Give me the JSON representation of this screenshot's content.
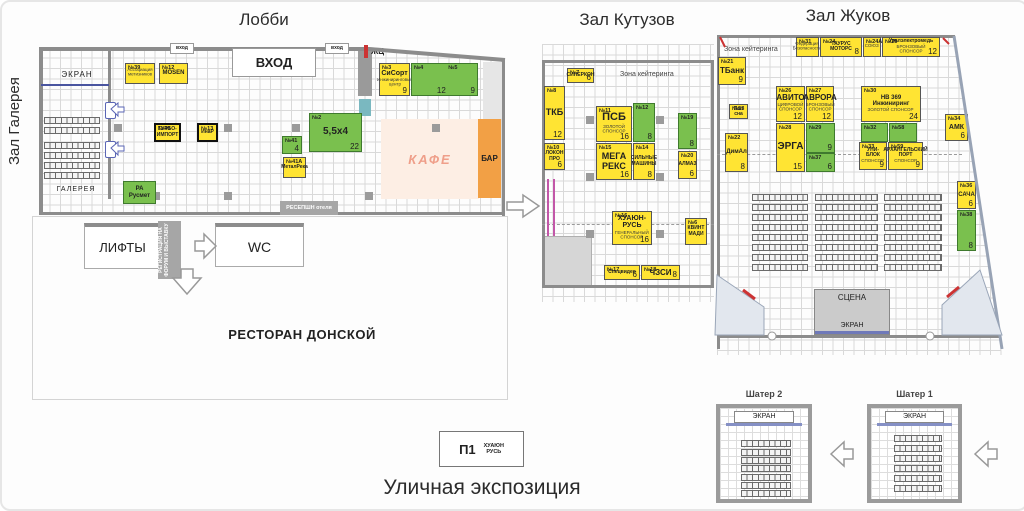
{
  "colors": {
    "yellow": "#ffe433",
    "green": "#7ac04e",
    "orange": "#f2a045",
    "cafe_bg": "#fdeee4",
    "cafe_text": "#ef9f8a",
    "wall": "#8c8c8c",
    "screen_bar": "#8590c5",
    "stage_bg": "#cbcbcb",
    "gray_box": "#a6a6a6",
    "red": "#cc3333"
  },
  "titles": {
    "lobby": "Лобби",
    "kutuzov": "Зал Кутузов",
    "zhukov": "Зал Жуков",
    "gallery_vertical": "Зал Галерея",
    "street": "Уличная экспозиция"
  },
  "lobby": {
    "entrance_big": "ВХОД",
    "entrance_small": "вход",
    "zh": "ЖЦ",
    "screen": "ЭКРАН",
    "gallery": "ГАЛЕРЕЯ",
    "cafe": "КАФЕ",
    "bar": "БАР",
    "reception": "РЕСЕПШН отеля",
    "stands": [
      {
        "num": "№39",
        "sub": "Ассоциация метизников",
        "x": 123,
        "y": 61,
        "w": 30,
        "h": 21,
        "type": "yellow"
      },
      {
        "num": "№12",
        "name": "MOSEN",
        "fs": 6,
        "x": 157,
        "y": 61,
        "w": 29,
        "h": 21,
        "type": "yellow"
      },
      {
        "num": "№40",
        "name": "ТУРБО-ИМПОРТ",
        "fs": 5,
        "x": 152,
        "y": 121,
        "w": 27,
        "h": 19,
        "type": "yellow",
        "bold": true
      },
      {
        "num": "№13",
        "name": "ИнаР",
        "fs": 5,
        "x": 195,
        "y": 121,
        "w": 21,
        "h": 19,
        "type": "yellow",
        "bold": true
      },
      {
        "num": "№41",
        "size": "4",
        "x": 280,
        "y": 134,
        "w": 20,
        "h": 18,
        "type": "green"
      },
      {
        "num": "№41А",
        "name": "МеталРека",
        "fs": 5,
        "x": 281,
        "y": 155,
        "w": 23,
        "h": 21,
        "type": "yellow"
      },
      {
        "num": "№2",
        "name": "5,5x4",
        "fs": 10,
        "size": "22",
        "x": 307,
        "y": 111,
        "w": 53,
        "h": 39,
        "type": "green"
      },
      {
        "num": "№3",
        "name": "СиСорт",
        "fs": 7,
        "sub": "Инжиниринговый центр",
        "size": "9",
        "x": 377,
        "y": 61,
        "w": 31,
        "h": 33,
        "type": "yellow"
      },
      {
        "num": "№4",
        "num2": "№5",
        "size": "12",
        "size2": "9",
        "x": 409,
        "y": 61,
        "w": 67,
        "h": 33,
        "type": "green"
      },
      {
        "name": "РА Русмет",
        "fs": 6,
        "x": 121,
        "y": 179,
        "w": 33,
        "h": 23,
        "type": "green"
      }
    ]
  },
  "services": {
    "lifts": "ЛИФТЫ",
    "wc": "WC",
    "registration": "РЕГИСТРАЦИЯ НА ФОРУМ И ВЫСТАВКУ",
    "restaurant": "РЕСТОРАН ДОНСКОЙ"
  },
  "kutuzov": {
    "catering": "Зона кейтеринга",
    "stands": [
      {
        "num": "№7",
        "name": "СИНЕРКОН",
        "fs": 5,
        "size": "6",
        "x": 565,
        "y": 66,
        "w": 27,
        "h": 15,
        "type": "yellow"
      },
      {
        "num": "№8",
        "name": "ТКБ",
        "fs": 9,
        "size": "12",
        "x": 542,
        "y": 84,
        "w": 21,
        "h": 54,
        "type": "yellow"
      },
      {
        "num": "№11",
        "name": "ПСБ",
        "fs": 11,
        "sub": "ЗОЛОТОЙ СПОНСОР",
        "size": "16",
        "x": 594,
        "y": 104,
        "w": 36,
        "h": 36,
        "type": "yellow"
      },
      {
        "num": "№12",
        "size": "8",
        "x": 631,
        "y": 101,
        "w": 22,
        "h": 39,
        "type": "green"
      },
      {
        "num": "№19",
        "size": "8",
        "x": 676,
        "y": 111,
        "w": 19,
        "h": 36,
        "type": "green"
      },
      {
        "num": "№10",
        "name": "ЛОКОН ПРО",
        "fs": 5,
        "size": "6",
        "x": 542,
        "y": 141,
        "w": 21,
        "h": 27,
        "type": "yellow"
      },
      {
        "num": "№15",
        "name": "МЕГА РЕКС",
        "fs": 9,
        "size": "16",
        "x": 594,
        "y": 141,
        "w": 36,
        "h": 37,
        "type": "yellow"
      },
      {
        "num": "№14",
        "name": "СИЛЬНЫЕ МАШИНЫ",
        "fs": 5,
        "size": "8",
        "x": 631,
        "y": 141,
        "w": 22,
        "h": 37,
        "type": "yellow"
      },
      {
        "num": "№20",
        "name": "АЛМАЗ",
        "fs": 5,
        "size": "6",
        "x": 676,
        "y": 149,
        "w": 19,
        "h": 28,
        "type": "yellow"
      },
      {
        "num": "№16",
        "name": "ХУАЮН-РУСЬ",
        "fs": 7,
        "sub": "ГЕНЕРАЛЬНЫЙ СПОНСОР",
        "size": "16",
        "x": 610,
        "y": 209,
        "w": 40,
        "h": 34,
        "type": "yellow"
      },
      {
        "num": "№6",
        "name": "КВИНТ МАДИ",
        "fs": 5,
        "x": 683,
        "y": 216,
        "w": 22,
        "h": 27,
        "type": "yellow"
      },
      {
        "num": "№17",
        "name": "Спецвидео",
        "fs": 5,
        "size": "6",
        "x": 602,
        "y": 263,
        "w": 36,
        "h": 15,
        "type": "yellow"
      },
      {
        "num": "№18",
        "name": "ЧЗСИ",
        "fs": 8,
        "size": "8",
        "x": 639,
        "y": 263,
        "w": 39,
        "h": 15,
        "type": "yellow"
      }
    ]
  },
  "zhukov": {
    "catering": "Зона кейтеринга",
    "stage": "СЦЕНА",
    "stage_screen": "ЭКРАН",
    "stands": [
      {
        "num": "№21",
        "name": "ТБанк",
        "fs": 8,
        "size": "9",
        "x": 716,
        "y": 55,
        "w": 28,
        "h": 28,
        "type": "yellow"
      },
      {
        "num": "№31",
        "sub": "Федерация Безопасности",
        "x": 794,
        "y": 35,
        "w": 23,
        "h": 20,
        "type": "yellow"
      },
      {
        "num": "№24",
        "name": "ТАУРУС МОТОРС",
        "fs": 5,
        "size": "8",
        "x": 818,
        "y": 35,
        "w": 42,
        "h": 20,
        "type": "yellow"
      },
      {
        "num": "№24А",
        "sub": "СОЮЗ",
        "x": 861,
        "y": 35,
        "w": 18,
        "h": 20,
        "type": "yellow"
      },
      {
        "num": "№25",
        "name": "Уралэлектромедь",
        "fs": 5,
        "sub": "БРОНЗОВЫЙ СПОНСОР",
        "size": "12",
        "x": 880,
        "y": 35,
        "w": 58,
        "h": 20,
        "type": "yellow"
      },
      {
        "num": "№53",
        "name": "Пап сна",
        "fs": 5,
        "x": 727,
        "y": 102,
        "w": 19,
        "h": 15,
        "type": "yellow"
      },
      {
        "num": "№26",
        "name": "АВИТО",
        "fs": 8,
        "sub": "ЦИФРОВОЙ СПОНСОР",
        "size": "12",
        "x": 774,
        "y": 84,
        "w": 29,
        "h": 36,
        "type": "yellow"
      },
      {
        "num": "№27",
        "name": "АВРОРА",
        "fs": 8,
        "sub": "БРОНЗОВЫЙ СПОНСОР",
        "size": "12",
        "x": 804,
        "y": 84,
        "w": 28,
        "h": 36,
        "type": "yellow"
      },
      {
        "num": "№30",
        "name": "НВ 369 Инжиниринг",
        "fs": 6,
        "sub": "ЗОЛОТОЙ СПОНСОР",
        "size": "24",
        "x": 859,
        "y": 84,
        "w": 60,
        "h": 36,
        "type": "yellow"
      },
      {
        "num": "№22",
        "name": "ДимАл",
        "fs": 6,
        "size": "8",
        "x": 723,
        "y": 131,
        "w": 23,
        "h": 39,
        "type": "yellow"
      },
      {
        "num": "№28",
        "name": "ЭРГА",
        "fs": 10,
        "size": "15",
        "x": 774,
        "y": 121,
        "w": 29,
        "h": 49,
        "type": "yellow"
      },
      {
        "num": "№29",
        "size": "9",
        "x": 804,
        "y": 121,
        "w": 29,
        "h": 30,
        "type": "green"
      },
      {
        "num": "№37",
        "size": "6",
        "x": 804,
        "y": 151,
        "w": 29,
        "h": 19,
        "type": "green"
      },
      {
        "num": "№32",
        "x": 859,
        "y": 121,
        "w": 27,
        "h": 19,
        "type": "green"
      },
      {
        "num": "№58",
        "x": 887,
        "y": 121,
        "w": 28,
        "h": 19,
        "type": "green"
      },
      {
        "num": "№33",
        "name": "УНИ-БЛОК",
        "fs": 5,
        "sub": "СПОНСОР",
        "size": "9",
        "x": 857,
        "y": 140,
        "w": 28,
        "h": 28,
        "type": "yellow"
      },
      {
        "num": "№59",
        "name": "АРХАНГЕЛЬСКИЙ ПОРТ",
        "fs": 5,
        "sub": "СПОНСОР",
        "size": "9",
        "x": 886,
        "y": 140,
        "w": 35,
        "h": 28,
        "type": "yellow"
      },
      {
        "num": "№34",
        "name": "АМК",
        "fs": 7,
        "size": "6",
        "x": 943,
        "y": 112,
        "w": 23,
        "h": 27,
        "type": "yellow"
      },
      {
        "num": "№36",
        "name": "САЧА",
        "fs": 6,
        "size": "6",
        "x": 955,
        "y": 179,
        "w": 19,
        "h": 28,
        "type": "yellow"
      },
      {
        "num": "№38",
        "size": "8",
        "x": 955,
        "y": 208,
        "w": 19,
        "h": 41,
        "type": "green"
      }
    ]
  },
  "tents": {
    "tent2": {
      "title": "Шатер 2",
      "screen": "ЭКРАН"
    },
    "tent1": {
      "title": "Шатер 1",
      "screen": "ЭКРАН"
    }
  },
  "street": {
    "p1": "П1",
    "p1_company": "ХУАЮН\nРУСЬ"
  }
}
